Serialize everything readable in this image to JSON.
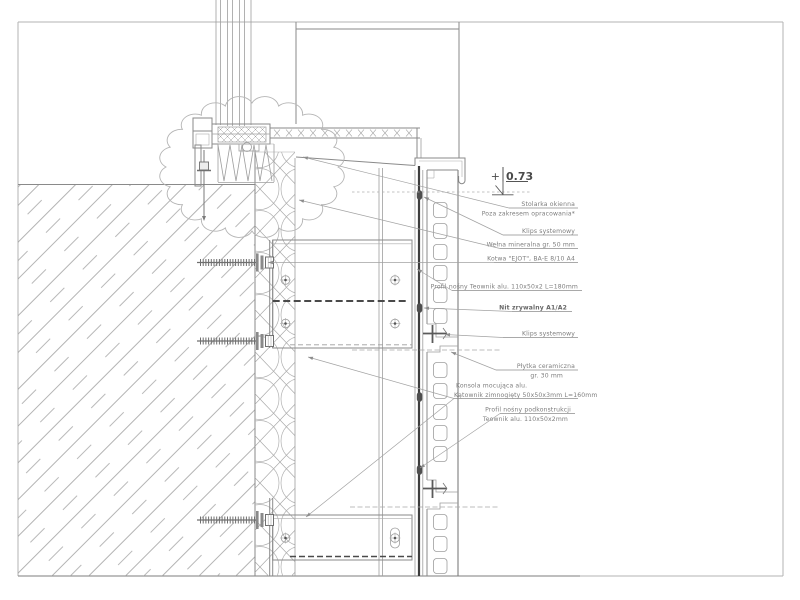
{
  "drawing": {
    "kind": "facade-section-detail",
    "language": "pl",
    "colors": {
      "line": "#8a8a8a",
      "dark_profile": "#3d3d3d",
      "text": "#7d7d7d",
      "frame": "#b3b3b3"
    },
    "level_mark": {
      "sign": "+",
      "value": "0.73"
    },
    "annotations": [
      {
        "id": "stolarka",
        "anchor": "end",
        "x": 575,
        "y": 206,
        "lines": [
          {
            "t": "Stolarka okienna"
          },
          {
            "t": "Poza zakresem opracowania*"
          }
        ],
        "underline": {
          "x1": 509,
          "y": 208,
          "x2": 578
        },
        "leaders": [
          [
            303,
            157
          ]
        ]
      },
      {
        "id": "klips-1",
        "anchor": "end",
        "x": 575,
        "y": 233,
        "lines": [
          {
            "t": "Klips systemowy"
          }
        ],
        "underline": {
          "x1": 503,
          "y": 235,
          "x2": 578
        },
        "leaders": [
          [
            424,
            197
          ]
        ]
      },
      {
        "id": "welna",
        "anchor": "end",
        "x": 575,
        "y": 246.5,
        "lines": [
          {
            "t": "Wełna mineralna gr. 50 mm"
          }
        ],
        "underline": {
          "x1": 500,
          "y": 248.5,
          "x2": 578
        },
        "leaders": [
          [
            299,
            200
          ]
        ]
      },
      {
        "id": "kotwa",
        "anchor": "end",
        "x": 575,
        "y": 260.5,
        "lines": [
          {
            "t": "Kotwa \"EJOT\", BA-E 8/10 A4"
          }
        ],
        "underline": {
          "x1": 494,
          "y": 262.5,
          "x2": 578
        },
        "leaders": [
          [
            268,
            262.5
          ]
        ]
      },
      {
        "id": "profil-teownik",
        "anchor": "end",
        "x": 578,
        "y": 288.5,
        "lines": [
          {
            "t": "Profil nośny Teownik alu. 110x50x2 L=180mm"
          }
        ],
        "underline": {
          "x1": 452,
          "y": 290.5,
          "x2": 582
        },
        "leaders": [
          [
            417,
            269
          ]
        ]
      },
      {
        "id": "nit",
        "anchor": "end",
        "x": 567,
        "y": 309.5,
        "lines": [
          {
            "t": "Nit zrywalny A1/A2",
            "bold": true
          }
        ],
        "underline": {
          "x1": 512,
          "y": 311.5,
          "x2": 572
        },
        "leaders": [
          [
            424,
            308
          ]
        ]
      },
      {
        "id": "klips-2",
        "anchor": "end",
        "x": 575,
        "y": 335.5,
        "lines": [
          {
            "t": "Klips systemowy"
          }
        ],
        "underline": {
          "x1": 503,
          "y": 337.5,
          "x2": 578
        },
        "leaders": [
          [
            445,
            334.5
          ]
        ]
      },
      {
        "id": "plytka",
        "anchor": "end",
        "x": 575,
        "y": 368,
        "lines": [
          {
            "t": "Płytka ceramiczna"
          },
          {
            "t": "gr. 30 mm",
            "x": 563
          }
        ],
        "underline": {
          "x1": 496,
          "y": 370,
          "x2": 578
        },
        "leaders": [
          [
            451,
            352
          ]
        ]
      },
      {
        "id": "konsola",
        "anchor": "start",
        "x": 456,
        "y": 387.5,
        "lines": [
          {
            "t": "Konsola mocująca alu."
          },
          {
            "t": "Kątownik zimnogięty 50x50x3mm L=160mm",
            "x": 454
          }
        ],
        "underline": {
          "x1": 454,
          "y": 398.5,
          "x2": 578
        },
        "leaders": [
          [
            308,
            357
          ],
          [
            306,
            517
          ]
        ]
      },
      {
        "id": "profil-podkonstrukcja",
        "anchor": "end",
        "x": 571,
        "y": 411.5,
        "lines": [
          {
            "t": "Profil nośny podkonstrukcji"
          },
          {
            "t": "Teownik alu. 110x50x2mm",
            "x": 568
          }
        ],
        "underline": {
          "x1": 500,
          "y": 413.5,
          "x2": 575
        },
        "leaders": [
          [
            420,
            468
          ]
        ]
      }
    ]
  }
}
